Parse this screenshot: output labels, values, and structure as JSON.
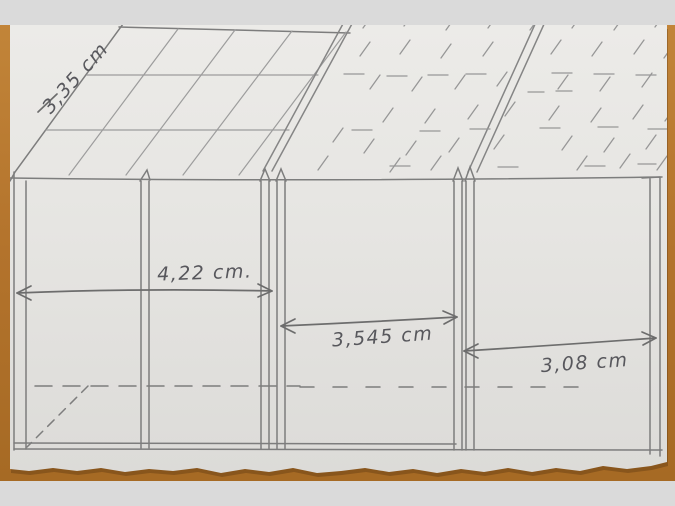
{
  "sketch": {
    "dimensions": [
      {
        "id": "roof-slope-depth",
        "label": "3,35 cm"
      },
      {
        "id": "section-left-width",
        "label": "4,22 cm."
      },
      {
        "id": "section-middle-width",
        "label": "3,545 cm"
      },
      {
        "id": "section-right-width",
        "label": "3,08 cm"
      }
    ],
    "unit": "cm"
  },
  "colors": {
    "backdrop": "#dadada",
    "wood": "#b5772c",
    "paper": "#e9e8e5",
    "pencil": "#7d7d7d",
    "handwriting": "#57575c"
  }
}
